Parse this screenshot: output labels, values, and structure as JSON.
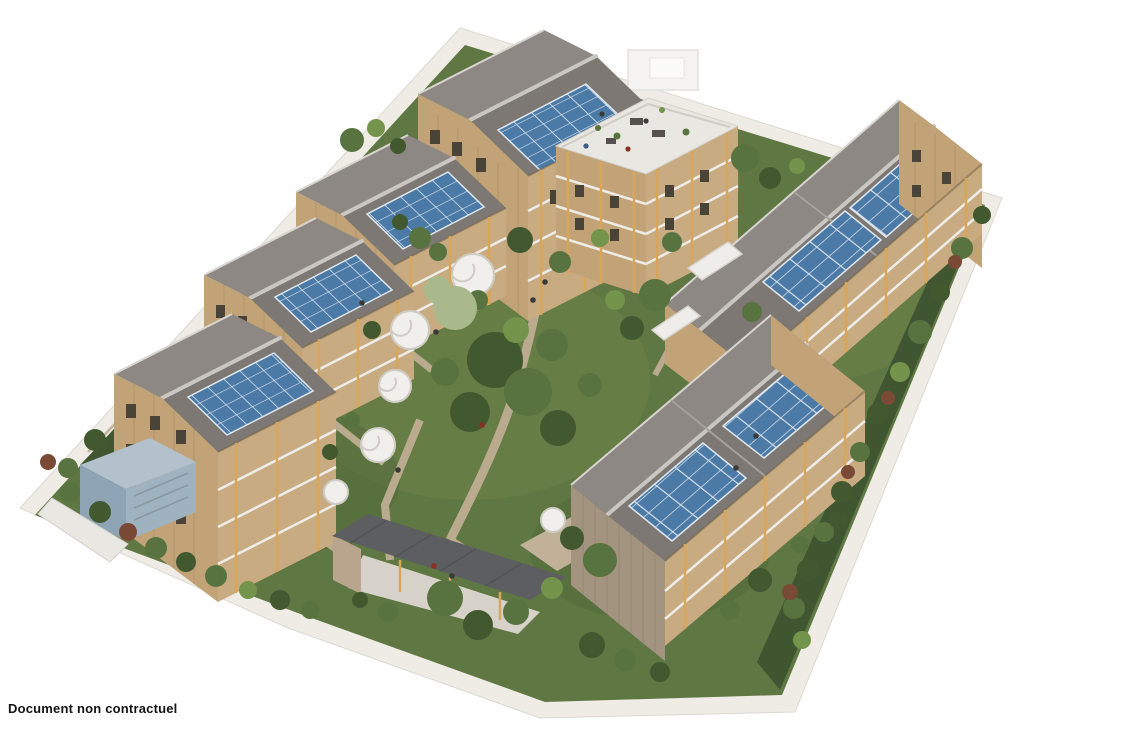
{
  "page": {
    "background": "#ffffff"
  },
  "caption": {
    "text": "Document non contractuel"
  },
  "palette": {
    "page_white": "#ffffff",
    "caption_ink": "#121212",
    "solar_panel_blue": "#4c7aa6",
    "solar_grid_white": "#e8eef5",
    "roof_gray": "#7d7874",
    "ridge_cap": "#cac7c2",
    "wood_facade": "#c2a377",
    "timber_frame": "#d7a55c",
    "balustrade_white": "#edece8",
    "grass_green": "#5f7743",
    "tree_dark": "#42582f",
    "tree_mid": "#587340",
    "path_beige": "#bfae92",
    "pavement_white": "#efece6",
    "terrace_white": "#e9e7e2",
    "utility_blue_gray": "#9fb2c0"
  },
  "scene": {
    "view": "isometric-aerial",
    "site_shape": "parallelogram-parcel",
    "buildings": [
      {
        "id": "central-building",
        "features": [
          "pitched-solar-roof",
          "roof-terrace",
          "balconies"
        ]
      },
      {
        "id": "west-row-building-1",
        "features": [
          "pitched-solar-roof",
          "balconies"
        ]
      },
      {
        "id": "west-row-building-2",
        "features": [
          "pitched-solar-roof",
          "balconies"
        ]
      },
      {
        "id": "west-row-building-3",
        "features": [
          "pitched-solar-roof",
          "balconies"
        ]
      },
      {
        "id": "east-long-building",
        "features": [
          "pitched-solar-roof",
          "balconies"
        ]
      },
      {
        "id": "south-long-building",
        "features": [
          "pitched-solar-roof",
          "balconies"
        ]
      },
      {
        "id": "carport-shed",
        "features": [
          "mono-pitch-roof"
        ]
      },
      {
        "id": "utility-shelter",
        "features": [
          "flat-roof"
        ]
      }
    ],
    "landscape": [
      "central-lawn",
      "boardwalk-paths",
      "spiral-staircases",
      "perimeter-hedges",
      "trees",
      "residents"
    ]
  }
}
